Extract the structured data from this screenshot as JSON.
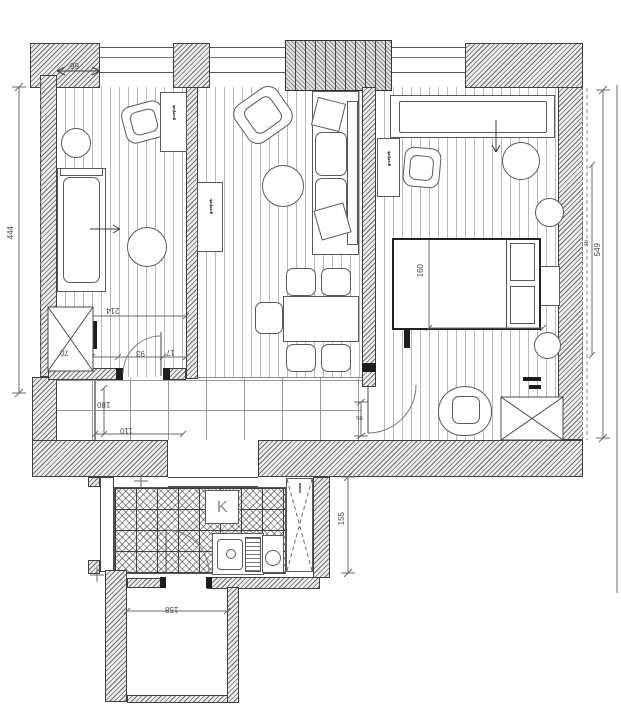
{
  "plan": {
    "dims": {
      "left_height": "444",
      "right_height": "549",
      "right_inner": "36",
      "top_window": "99",
      "room1_width": "214",
      "seg_left": "70",
      "seg_door": "93",
      "seg_right": "17",
      "hall_depth": "180",
      "hall_width": "110",
      "bedroom_door": "95",
      "bed_width": "160",
      "kitchen_offset": "155",
      "bottom_room_width": "158"
    },
    "labels": {
      "kitchen": "K",
      "radiator": "grzejnik",
      "tall_cabinet": "szafa"
    }
  }
}
